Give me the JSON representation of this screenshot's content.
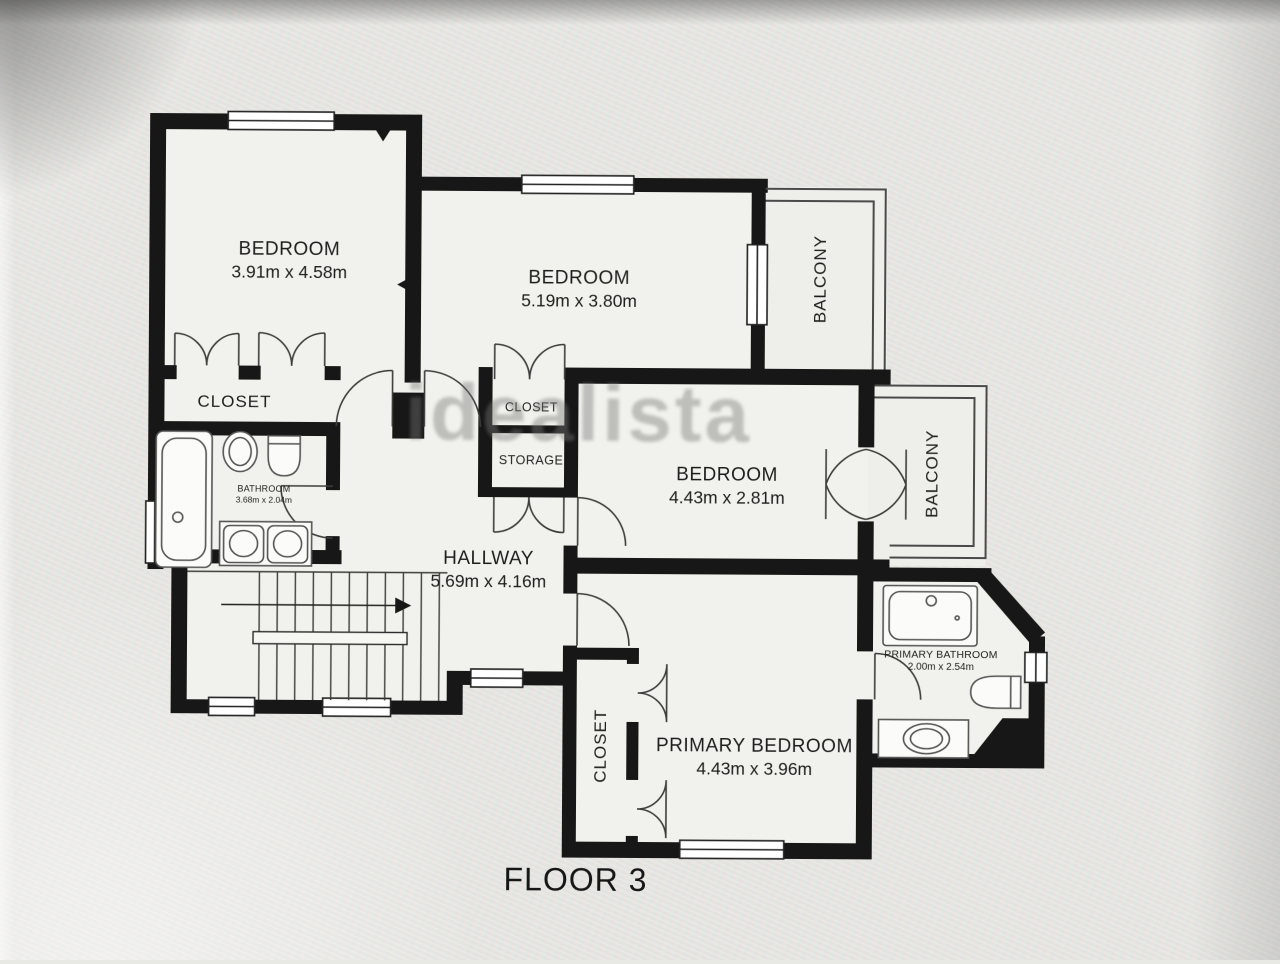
{
  "page": {
    "title": "FLOOR 3",
    "watermark": "idealista"
  },
  "rooms": {
    "bedroom_top_left": {
      "name": "BEDROOM",
      "dims": "3.91m x 4.58m"
    },
    "bedroom_top_mid": {
      "name": "BEDROOM",
      "dims": "5.19m x 3.80m"
    },
    "bedroom_mid_right": {
      "name": "BEDROOM",
      "dims": "4.43m x 2.81m"
    },
    "primary_bedroom": {
      "name": "PRIMARY BEDROOM",
      "dims": "4.43m x 3.96m"
    },
    "hallway": {
      "name": "HALLWAY",
      "dims": "5.69m x 4.16m"
    },
    "bathroom": {
      "name": "BATHROOM",
      "dims": "3.68m x 2.04m"
    },
    "primary_bathroom": {
      "name": "PRIMARY BATHROOM",
      "dims": "2.00m x 2.54m"
    },
    "closet_top_left": {
      "name": "CLOSET"
    },
    "closet_mid": {
      "name": "CLOSET"
    },
    "storage": {
      "name": "STORAGE"
    },
    "closet_primary": {
      "name": "CLOSET"
    },
    "balcony_top": {
      "name": "BALCONY"
    },
    "balcony_right": {
      "name": "BALCONY"
    }
  },
  "colors": {
    "wall": "#171717",
    "floor": "#f1f1ed",
    "background": "#e9e9e5",
    "thin_line": "#3d3d3d",
    "fixture_line": "#555555",
    "label_text": "#1e1e1e",
    "watermark_gray": "#787878"
  }
}
